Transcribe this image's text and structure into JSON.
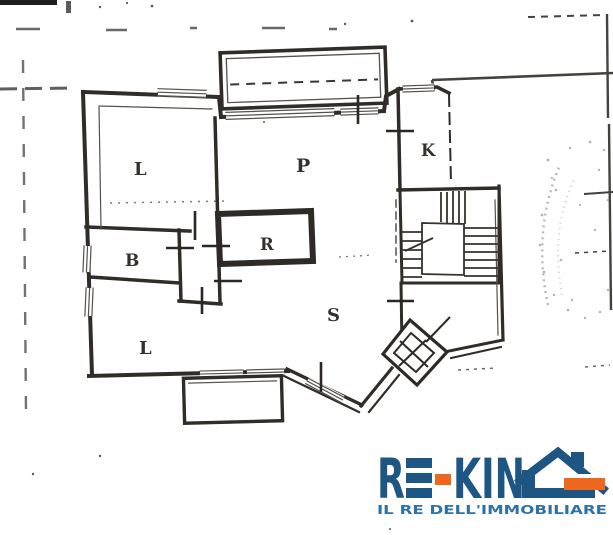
{
  "scan": {
    "background": "#ffffff",
    "ink": "#2e2a26"
  },
  "floorplan": {
    "room_labels": {
      "l1": "L",
      "p": "P",
      "k": "K",
      "b": "B",
      "r": "R",
      "s": "S",
      "l2": "L"
    }
  },
  "logo": {
    "brand": "RE-KING",
    "brand_r": "R",
    "brand_kin": "KIN",
    "tagline": "IL RE DELL'IMMOBILIARE",
    "colors": {
      "navy": "#1d5583",
      "orange": "#ee671f",
      "tagline_blue": "#2f73a6"
    }
  }
}
